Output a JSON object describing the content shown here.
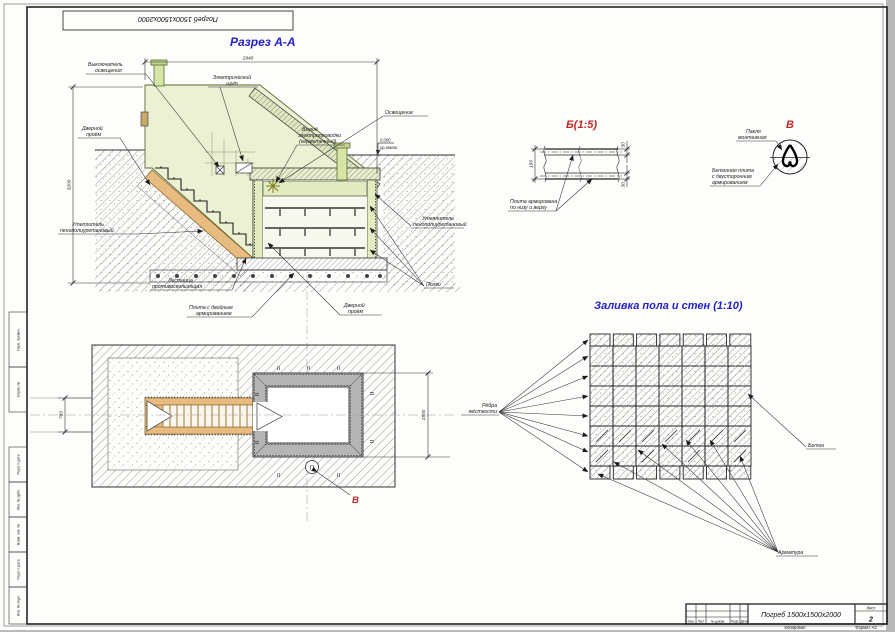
{
  "colors": {
    "accent_blue": "#2222c8",
    "accent_red": "#c42727",
    "wall_green": "#ecf1d4",
    "stair_orange": "#e8bc80",
    "plan_wall_gray": "#b5b5b5"
  },
  "frame": {
    "top_stamp": "Погреб 1500x1500x2000",
    "side_labels": [
      "Перв. примен.",
      "Справ. №",
      "Подп. и дата",
      "Инв. № дубл.",
      "Взам. инв. №",
      "Подп. и дата",
      "Инв. № подл."
    ]
  },
  "section": {
    "title": "Разрез А-А",
    "dim_width": "2940",
    "dim_height": "3200",
    "level_value": "0.000",
    "level_note": "ур.земли",
    "labels": {
      "switch": [
        "Выключатель",
        "освещения"
      ],
      "panel": [
        "Электрический",
        "щит"
      ],
      "door_top": [
        "Дверной",
        "проём"
      ],
      "insulation_left": [
        "Утеплитель",
        "пенополиуретановый"
      ],
      "stairs": [
        "Лестница",
        "противоскользящая"
      ],
      "slab": [
        "Плита с двойным",
        "армированием"
      ],
      "door_bottom": [
        "Дверной",
        "проём"
      ],
      "shelves": "Полки",
      "insulation_right": [
        "Утеплитель",
        "пенополиуретановый"
      ],
      "lighting": "Освещение",
      "wiring": [
        "Вывод",
        "электропроводки",
        "(герметичный)"
      ]
    }
  },
  "detail_b": {
    "title": "Б(1:5)",
    "dim_total": "150",
    "dim_top": "30",
    "dim_bottom": "30",
    "label": [
      "Плита армирована",
      "по низу и верху"
    ]
  },
  "detail_v": {
    "title": "В",
    "label_tow": [
      "Пакля",
      "монтажная"
    ],
    "label_slab": [
      "Бетонная плита",
      "с двусторонним",
      "армированием"
    ]
  },
  "plan": {
    "dim_left": "780",
    "dim_right": "1500",
    "detail_mark": "В",
    "hatch_glyph": "п",
    "circle_glyph": "П"
  },
  "pour": {
    "title": "Заливка пола и стен (1:10)",
    "label_ribs": [
      "Рёбра",
      "жёсткости"
    ],
    "label_concrete": "Бетон",
    "label_rebar": "Арматура"
  },
  "titleblock": {
    "project": "Погреб 1500x1500x2000",
    "sheet_label": "Лист",
    "sheet_number": "2",
    "col_headers": [
      "Изм.",
      "Лист",
      "№ докум.",
      "Подп.",
      "Дата"
    ],
    "copied": "Копировал",
    "format": "Формат А3"
  }
}
